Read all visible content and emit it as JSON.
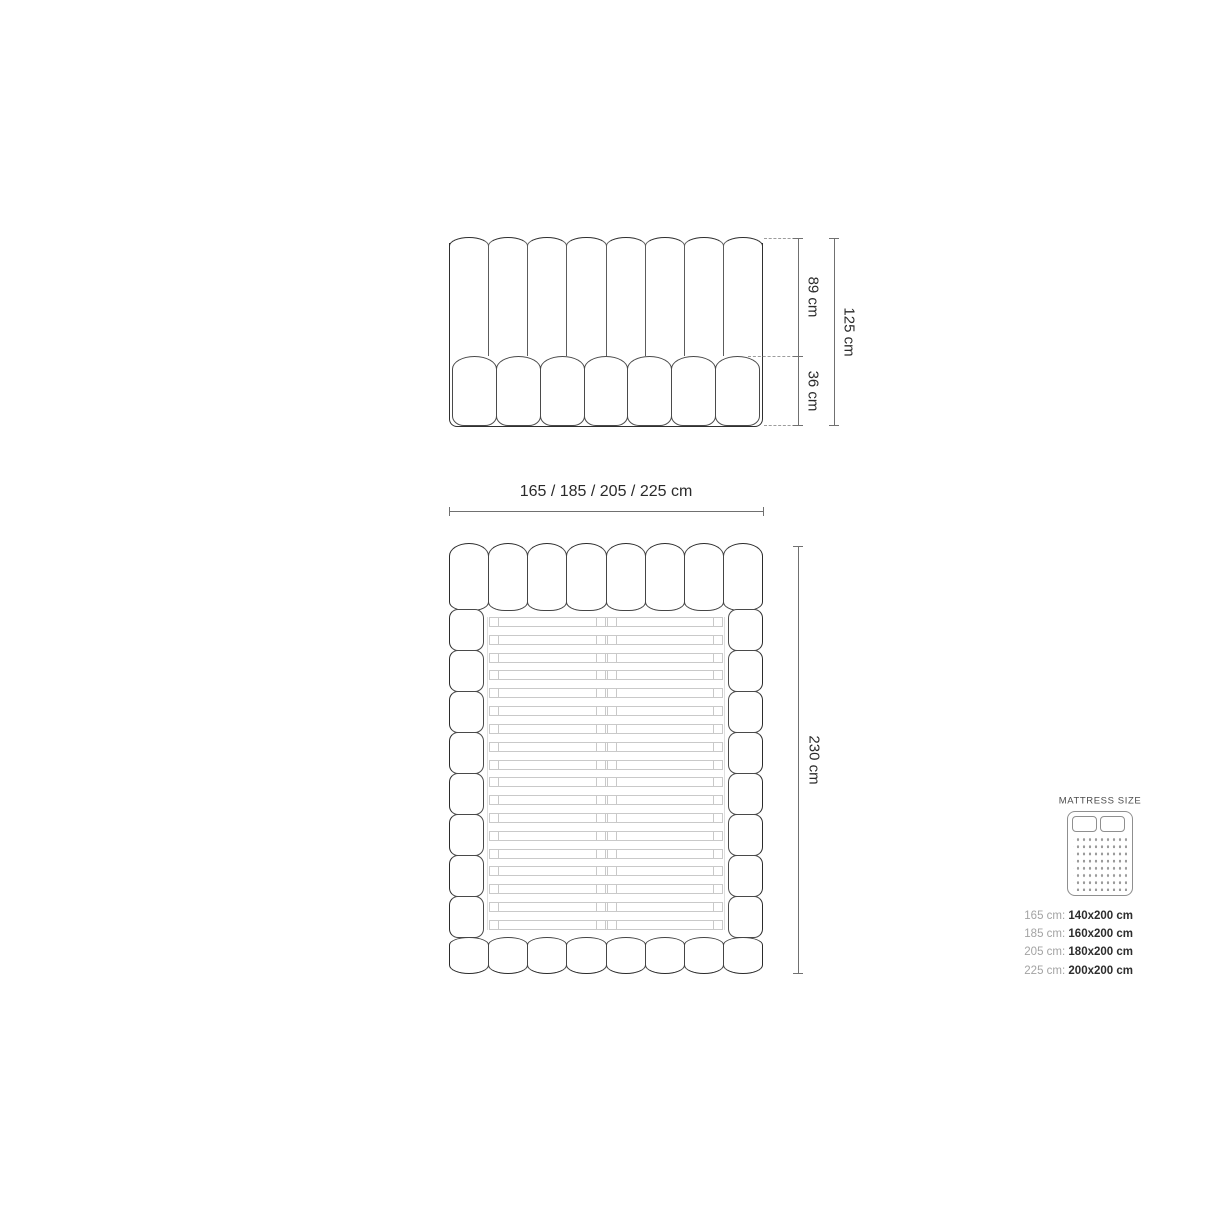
{
  "front_view": {
    "dim_upper": "89 cm",
    "dim_lower": "36 cm",
    "dim_total": "125 cm"
  },
  "width_dimension": "165 / 185 / 205 / 225 cm",
  "top_view": {
    "dim_length": "230 cm"
  },
  "mattress_panel": {
    "title": "MATTRESS SIZE",
    "sizes": [
      {
        "frame": "165 cm:",
        "mattress": "140x200 cm"
      },
      {
        "frame": "185 cm:",
        "mattress": "160x200 cm"
      },
      {
        "frame": "205 cm:",
        "mattress": "180x200 cm"
      },
      {
        "frame": "225 cm:",
        "mattress": "200x200 cm"
      }
    ]
  },
  "drawing": {
    "headboard_channels": 8,
    "front_base_cushions": 7,
    "top_head_cushions": 8,
    "top_foot_cushions": 8,
    "rail_segments_per_side": 8,
    "slats": 18
  },
  "colors": {
    "outline_dark": "#2f2f2f",
    "outline_mid": "#4a4a4a",
    "slat_gray": "#c9c9c9",
    "dimension_gray": "#707070",
    "label_dark": "#2b2b2b",
    "muted_text": "#a3a3a3"
  }
}
